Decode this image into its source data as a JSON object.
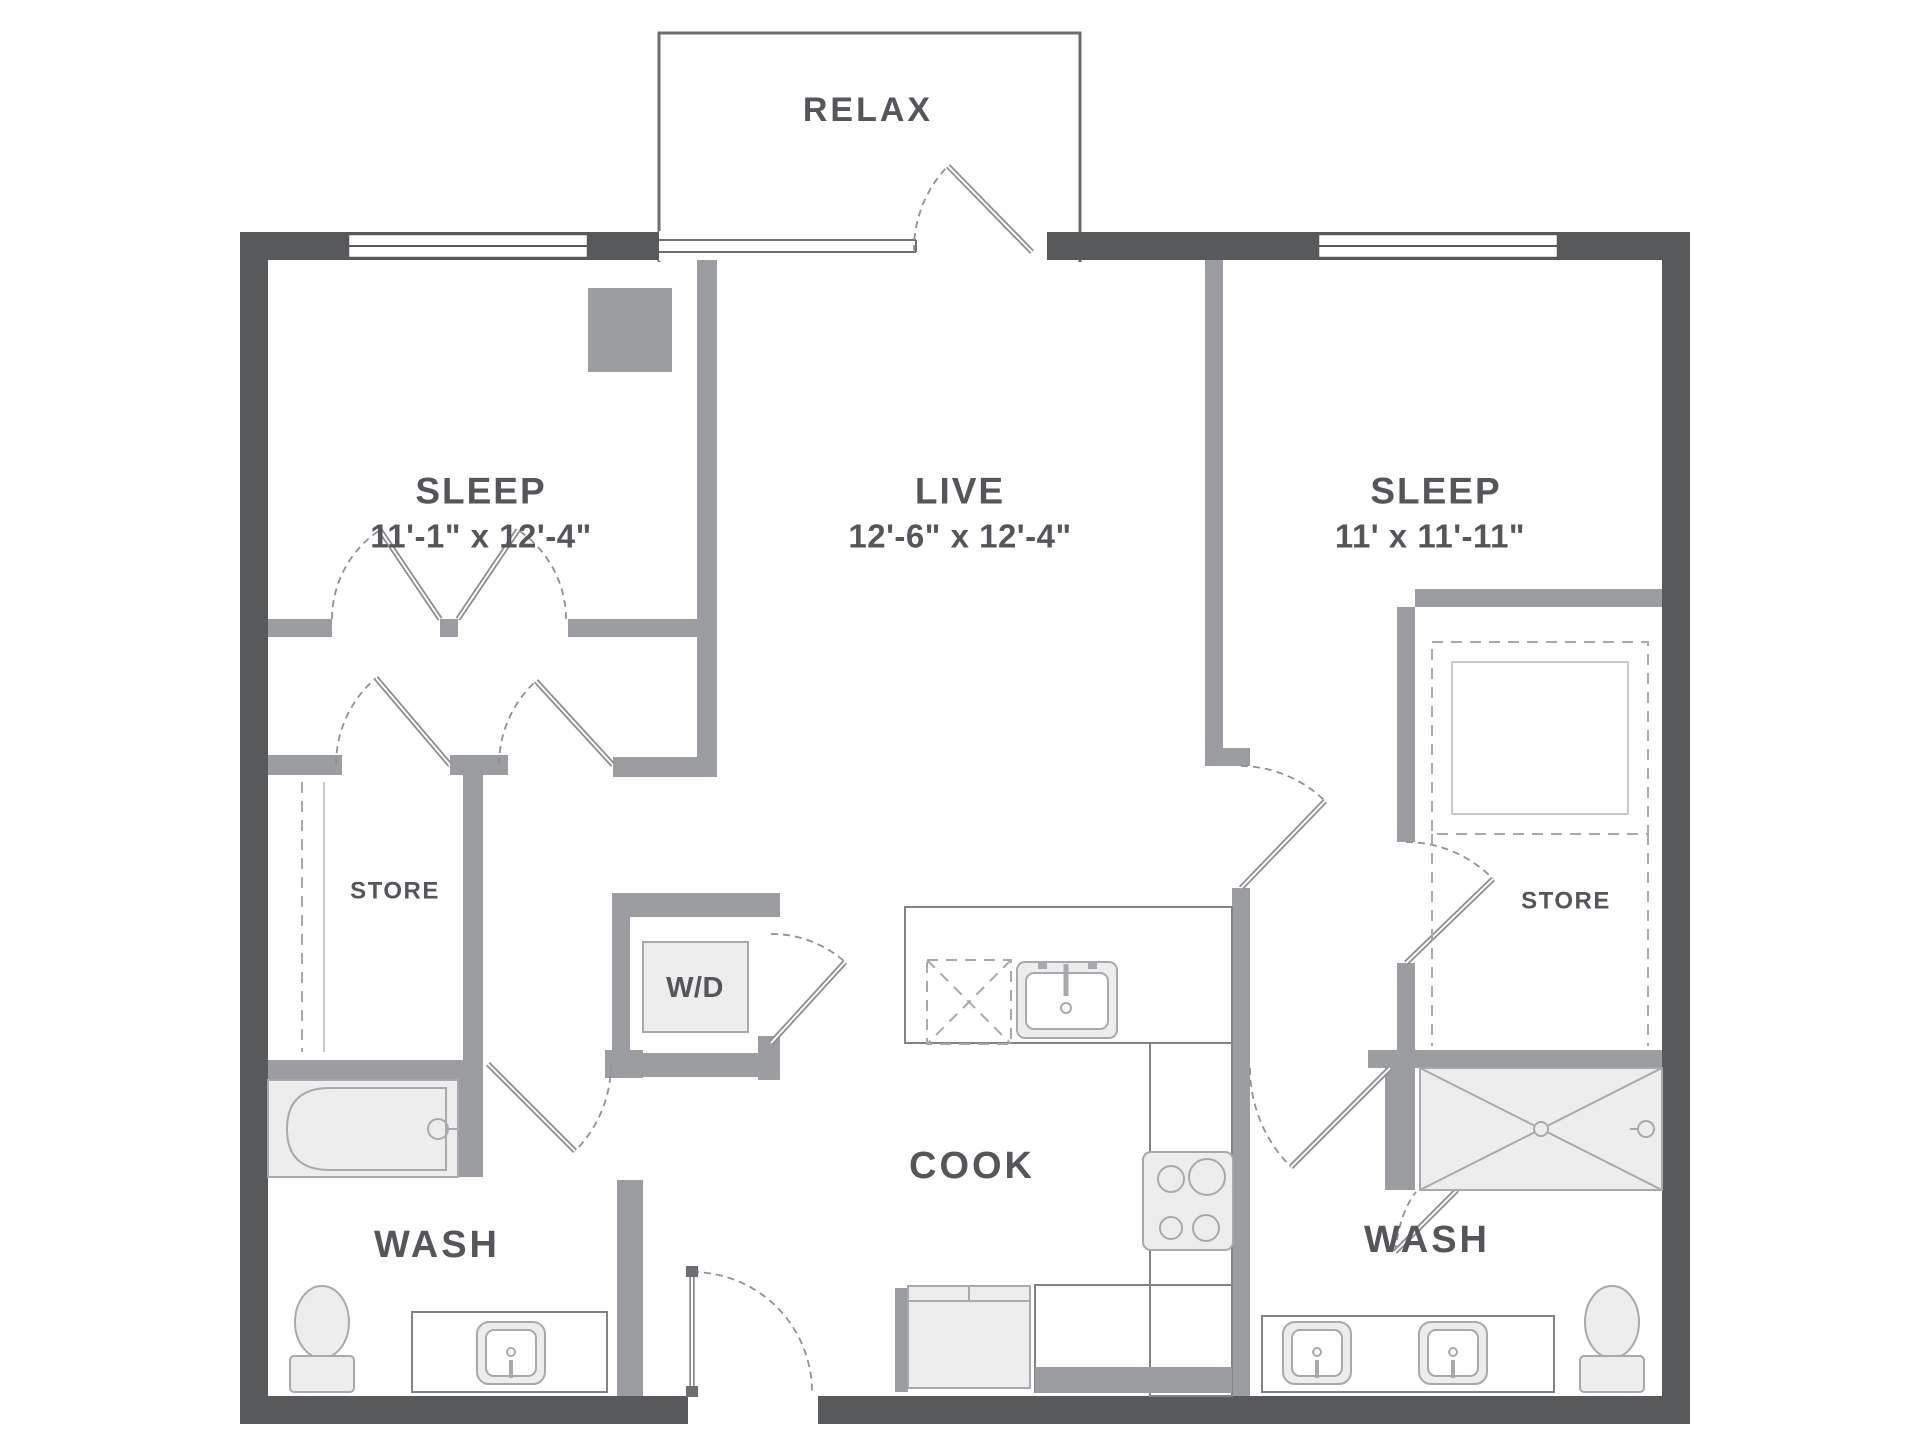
{
  "plan": {
    "balcony": {
      "label": "RELAX"
    },
    "bedroom_left": {
      "label": "SLEEP",
      "dimensions": "11'-1\" x 12'-4\""
    },
    "living": {
      "label": "LIVE",
      "dimensions": "12'-6\" x 12'-4\""
    },
    "bedroom_right": {
      "label": "SLEEP",
      "dimensions": "11' x 11'-11\""
    },
    "closet_left": {
      "label": "STORE"
    },
    "closet_right": {
      "label": "STORE"
    },
    "laundry": {
      "label": "W/D"
    },
    "kitchen": {
      "label": "COOK"
    },
    "bath_left": {
      "label": "WASH"
    },
    "bath_right": {
      "label": "WASH"
    }
  },
  "colors": {
    "wall_dark": "#58595b",
    "wall_gray": "#9b9da0",
    "outline": "#808285",
    "fixture_fill": "#ededee",
    "fixture_stroke": "#a7a9ac",
    "text": "#54565a",
    "background": "#ffffff"
  }
}
